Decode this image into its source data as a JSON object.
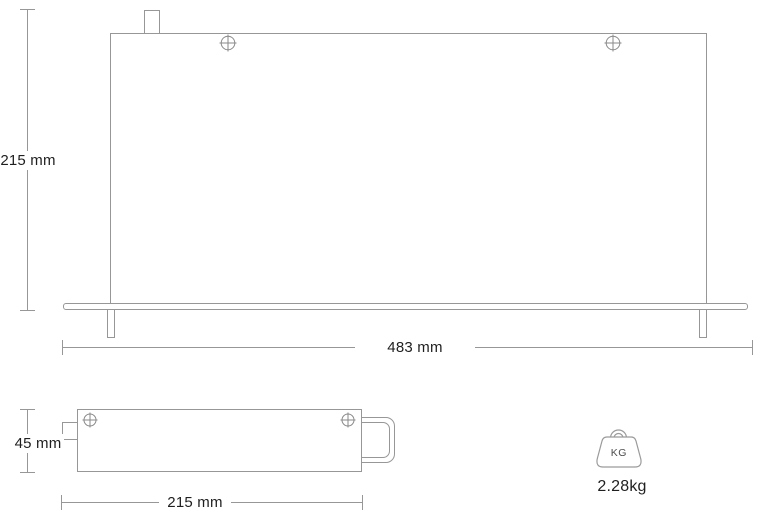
{
  "front_view": {
    "height_label": "215 mm",
    "width_label": "483 mm"
  },
  "side_view": {
    "height_label": "45 mm",
    "width_label": "215 mm"
  },
  "weight": {
    "unit_label": "KG",
    "value_label": "2.28kg"
  },
  "colors": {
    "line": "#979797",
    "text": "#1f1f1f",
    "background": "#ffffff"
  }
}
